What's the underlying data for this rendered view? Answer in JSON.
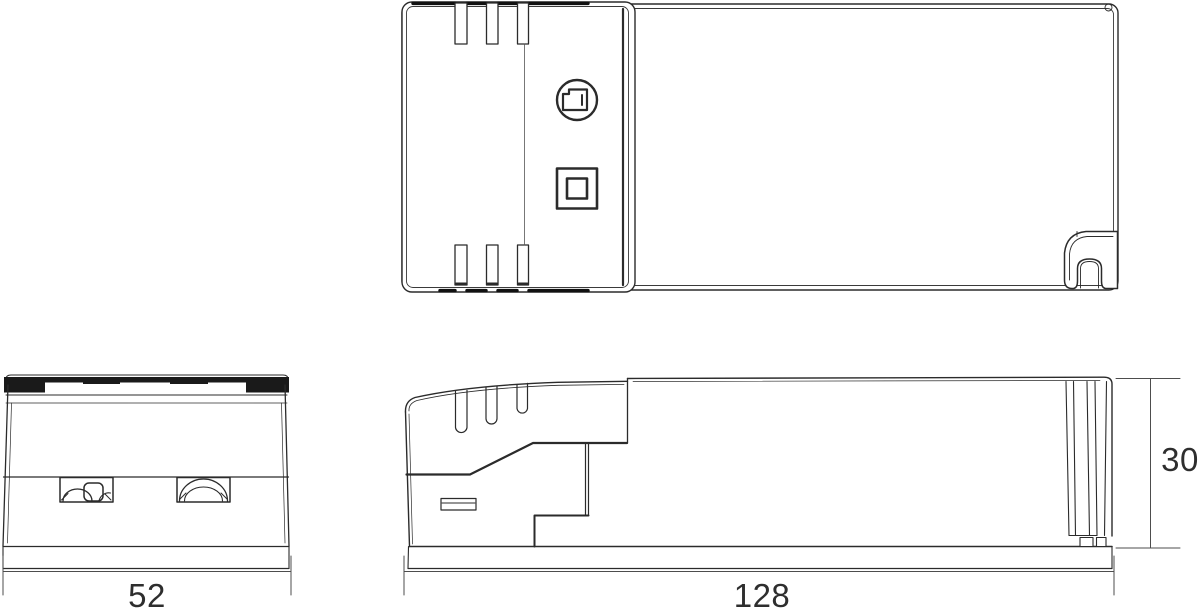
{
  "page": {
    "background": "#ffffff"
  },
  "drawing": {
    "line_color": "#2b2b2b",
    "dim_color": "#4d4d4d",
    "dimensions": {
      "width": "52",
      "length": "128",
      "height": "30"
    },
    "icons": {
      "class2_name": "class-ii-double-square-icon",
      "brand_name": "circled-bracket-mark-icon"
    }
  }
}
